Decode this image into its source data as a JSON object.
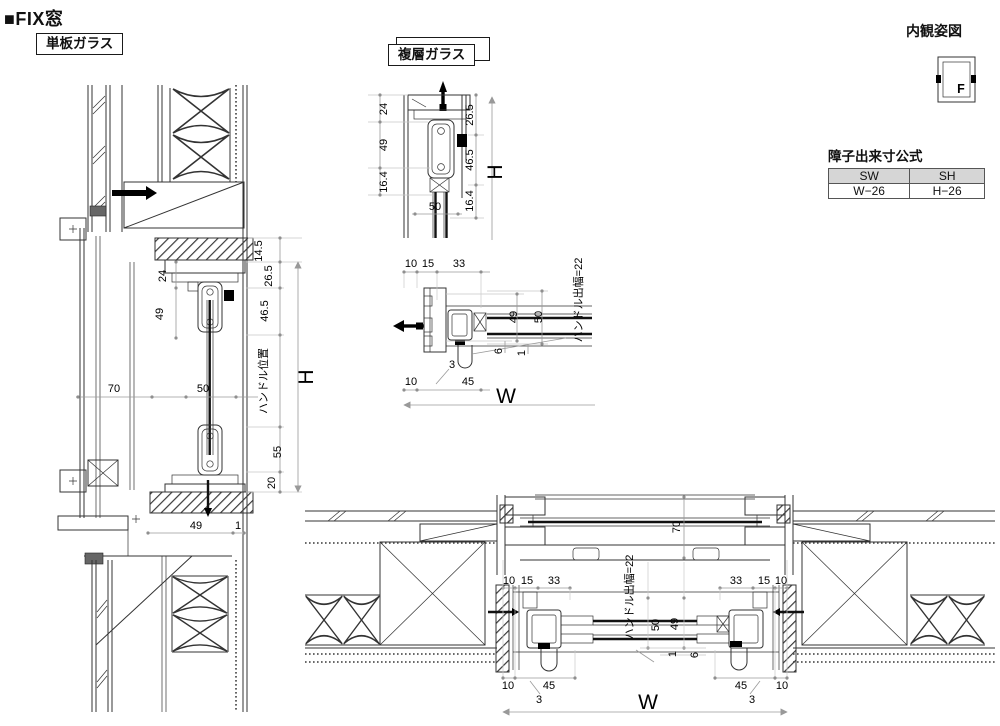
{
  "page": {
    "title": "■FIX窓"
  },
  "labels": {
    "single": "単板ガラス",
    "double": "複層ガラス",
    "interior_view": "内観姿図",
    "window_mark": "F"
  },
  "table": {
    "title": "障子出来寸公式",
    "col1": "SW",
    "col2": "SH",
    "val1": "W−26",
    "val2": "H−26"
  },
  "left": {
    "d145": "14.5",
    "d265": "26.5",
    "d24": "24",
    "d49": "49",
    "d465": "46.5",
    "H": "H",
    "handle_pos": "ハンドル位置",
    "d55": "55",
    "d20": "20",
    "d70": "70",
    "d50": "50",
    "d49b": "49",
    "d1": "1"
  },
  "midv": {
    "d24": "24",
    "d49": "49",
    "d164a": "16.4",
    "d265": "26.5",
    "d465": "46.5",
    "d164b": "16.4",
    "d50": "50",
    "H": "H"
  },
  "midp": {
    "d10a": "10",
    "d15": "15",
    "d33": "33",
    "d49": "49",
    "d50": "50",
    "d6": "6",
    "d1": "1",
    "d3": "3",
    "d10b": "10",
    "d45": "45",
    "W": "W",
    "handle": "ハンドル出幅=22"
  },
  "bottom": {
    "d70": "70",
    "handle": "ハンドル出幅=22",
    "lt10": "10",
    "lt15": "15",
    "lt33": "33",
    "rt33": "33",
    "rt15": "15",
    "rt10": "10",
    "d50": "50",
    "d49": "49",
    "d1": "1",
    "d6": "6",
    "lb10": "10",
    "l45": "45",
    "l3": "3",
    "r45": "45",
    "r3": "3",
    "rb10": "10",
    "W": "W"
  }
}
